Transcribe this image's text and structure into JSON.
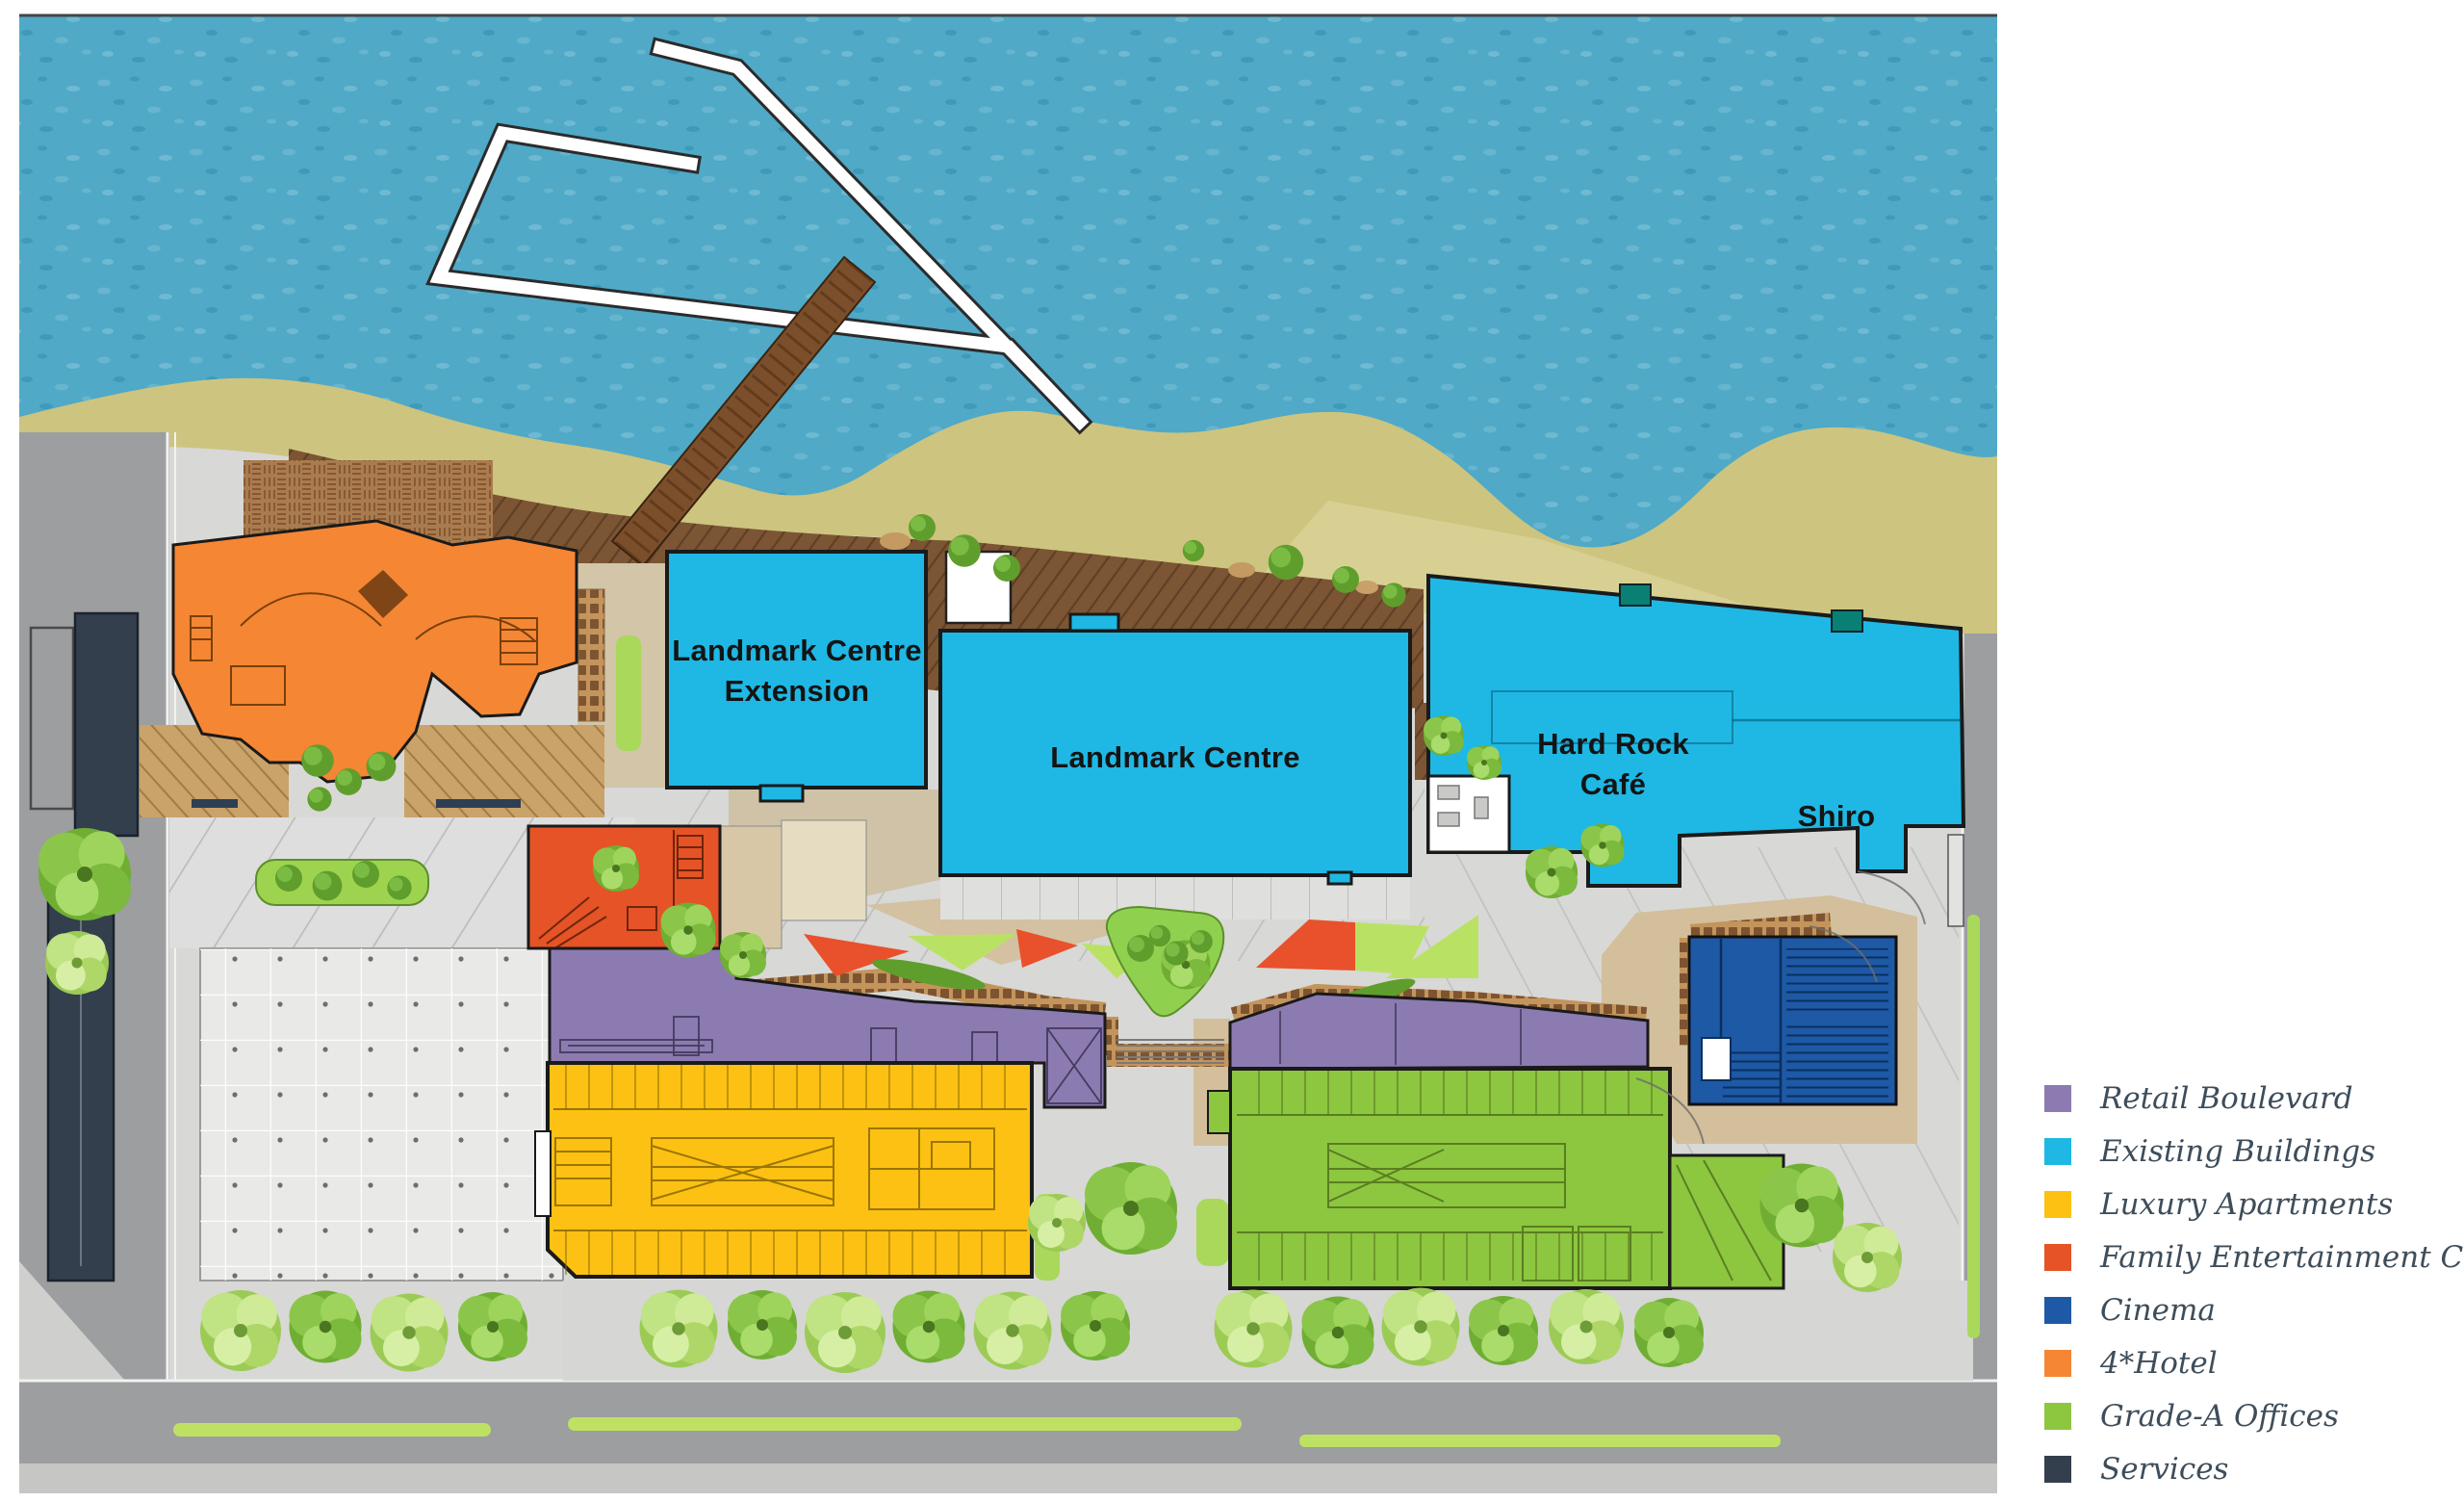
{
  "page": {
    "background": "#FFFFFF"
  },
  "map": {
    "description": "Beachfront mixed-use development masterplan site map",
    "building_labels": [
      {
        "id": "landmark-centre-extension",
        "text": "Landmark Centre\nExtension"
      },
      {
        "id": "landmark-centre",
        "text": "Landmark Centre"
      },
      {
        "id": "hard-rock-cafe",
        "text": "Hard Rock\nCafé"
      },
      {
        "id": "shiro",
        "text": "Shiro"
      }
    ],
    "palette": {
      "water": "#4FA9C7",
      "sand": "#CDC47F",
      "sand_light": "#DFD8A0",
      "boardwalk": "#7B5534",
      "pavement": "#D8D8D6",
      "plaza": "#E9E9E7",
      "deck_tan": "#D3BF9B",
      "courtyard_tan": "#CFC2A6",
      "road": "#9C9EA0",
      "lawn": "#A9D85B",
      "brick": "#C3945C",
      "bench": "#2E3F52",
      "accent_red": "#E8512B",
      "white_structure": "#FFFFFF"
    }
  },
  "legend": {
    "items": [
      {
        "label": "Retail Boulevard",
        "color": "#8C7BB1"
      },
      {
        "label": "Existing Buildings",
        "color": "#1FB8E4"
      },
      {
        "label": "Luxury Apartments",
        "color": "#FDC113"
      },
      {
        "label": "Family Entertainment Centre",
        "color": "#E55326"
      },
      {
        "label": "Cinema",
        "color": "#1E59A6"
      },
      {
        "label": "4*Hotel",
        "color": "#F58634"
      },
      {
        "label": "Grade-A Offices",
        "color": "#8DC63F"
      },
      {
        "label": "Services",
        "color": "#333F4D"
      }
    ]
  }
}
